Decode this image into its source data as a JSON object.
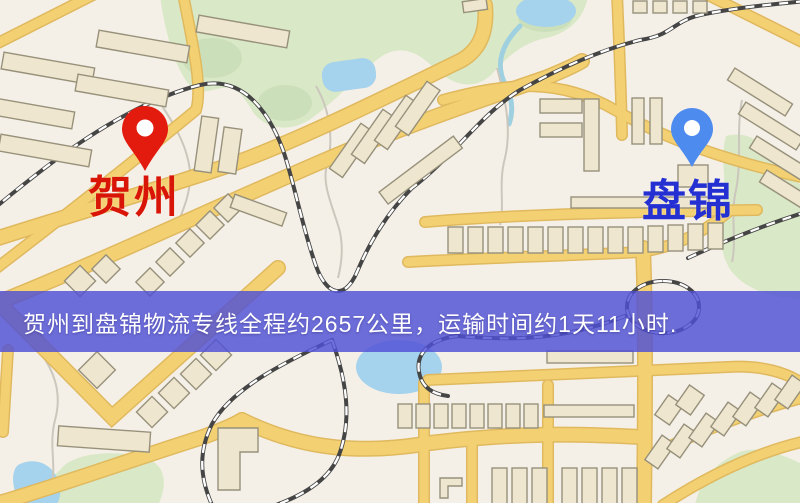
{
  "map": {
    "type": "static-route-map",
    "origin": {
      "label": "贺州",
      "pin_icon": "red-location-pin",
      "pin_color": "#e31a0e",
      "label_color": "#d91508"
    },
    "destination": {
      "label": "盘锦",
      "pin_icon": "blue-location-pin",
      "pin_color": "#4e8bee",
      "label_color": "#2430d2"
    },
    "banner": {
      "text": "贺州到盘锦物流专线全程约2657公里，运输时间约1天11小时.",
      "distance_km": "2657",
      "duration": "1天11小时",
      "background_color": "#4f4fd5",
      "text_color": "#ffffff"
    },
    "palette": {
      "map_background": "#f5f0e7",
      "road_fill": "#f3d173",
      "road_casing": "#e0b95f",
      "building_fill": "#eee6cf",
      "park_green": "#d9e8c6",
      "water_blue": "#a5d2ec",
      "railway_dark": "#454545"
    }
  }
}
